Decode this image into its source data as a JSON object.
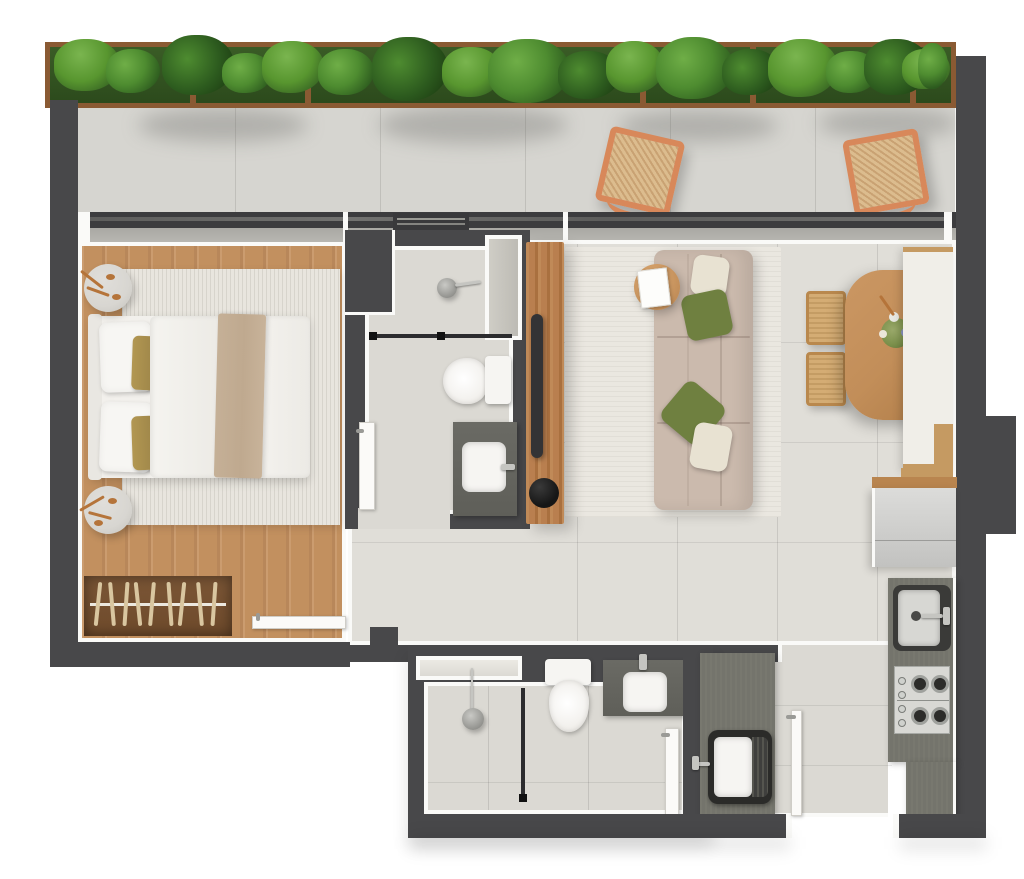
{
  "scene": {
    "type": "apartment-floor-plan",
    "view": "top-down-render",
    "rooms": [
      {
        "id": "balcony",
        "items": [
          "planter-hedge",
          "lounge-chair",
          "lounge-chair"
        ]
      },
      {
        "id": "bedroom",
        "items": [
          "double-bed",
          "area-rug",
          "side-table",
          "side-table",
          "wardrobe-with-hangers",
          "door"
        ]
      },
      {
        "id": "bathroom-top",
        "items": [
          "shower",
          "toilet",
          "vanity-sink",
          "duct-shaft",
          "door"
        ]
      },
      {
        "id": "living-dining",
        "items": [
          "sofa",
          "coffee-table",
          "tv-panel",
          "rug",
          "dining-table",
          "dining-chair",
          "dining-chair",
          "bench"
        ]
      },
      {
        "id": "kitchen",
        "items": [
          "refrigerator",
          "kitchen-sink",
          "cooktop",
          "counter"
        ]
      },
      {
        "id": "bathroom-bottom",
        "items": [
          "shower",
          "niche",
          "toilet",
          "vanity-sink",
          "door"
        ]
      },
      {
        "id": "laundry-entry",
        "items": [
          "laundry-sink",
          "counter",
          "entry-door"
        ]
      }
    ],
    "counts": {
      "lounge_chairs": 2,
      "hangers": 9,
      "burners": 4,
      "planter_dividers": 6,
      "sofa_pillows": 4
    }
  },
  "colors": {
    "page": "#ffffff",
    "wall": "#48484a",
    "outline": "#fafaf8",
    "balcony_floor": "#d6d5d0",
    "tile_floor": "#e0ded8",
    "tile_floor2": "#dbd9d3",
    "sill": "#a9a8a3",
    "track": "#3c3c3e",
    "wood_floor": "#c2905f",
    "wood_dark": "#6e4a2b",
    "wood_panel": "#b97f4f",
    "wood_table": "#c28e59",
    "rug_bed": "#e8e5de",
    "rug_living": "#eae7e0",
    "bed_white": "#f2f0ec",
    "blanket": "#bfa98f",
    "accent_gold": "#b29752",
    "copper": "#b5743a",
    "table_gray": "#d8d6d1",
    "hanger": "#d9c6a0",
    "sofa": "#cbbaad",
    "pillow_green": "#6f8040",
    "pillow_cream": "#e8e2d2",
    "chair_frame": "#d8885a",
    "chair_wicker": "#dcbc8e",
    "planter_frame": "#8a5a33",
    "leaf_dark": "#2c5a1e",
    "leaf_mid": "#4e8c30",
    "leaf_light": "#7ab54f",
    "counter_dark": "#74746c",
    "fixture_dark": "#5f5f59",
    "steel": "#d7d7d3",
    "white_fixture": "#f6f5f2",
    "chrome": "#c5c5c1",
    "glass_line": "#2c2c2e",
    "black": "#161616"
  }
}
